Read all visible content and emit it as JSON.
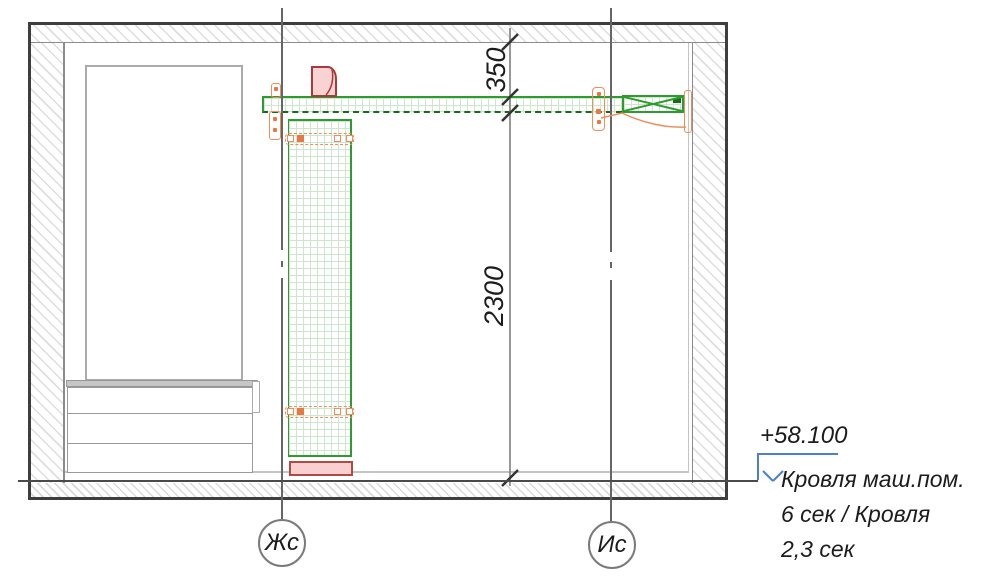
{
  "drawing": {
    "type": "construction-section-detail",
    "dimensions": [
      {
        "label": "350",
        "orientation": "vertical",
        "from": "ceiling-underside",
        "to": "beam-top"
      },
      {
        "label": "2300",
        "orientation": "vertical",
        "from": "beam-bottom",
        "to": "floor-level"
      }
    ],
    "axes": [
      {
        "label": "Жс"
      },
      {
        "label": "Ис"
      }
    ],
    "elevation_mark": {
      "value": "+58.100",
      "lines": [
        "Кровля маш.пом.",
        "6 сек / Кровля",
        "2,3 сек"
      ]
    }
  },
  "colors": {
    "outline": "#3e3e3e",
    "wall_line": "#8c8c8c",
    "light_line": "#c4c4c4",
    "hatch": "#dedede",
    "frame_gray": "#ababab",
    "green": "#2e9b2e",
    "green_dark": "#156e15",
    "green_grid": "#cde6cd",
    "orange": "#ef8d5c",
    "orange_fill": "#e87840",
    "red": "#b04a46",
    "red_dark": "#a83a3a",
    "pink": "#f9cfcf",
    "blue": "#4a7fd4",
    "text": "#1c1c1c",
    "axis_line": "#666666"
  }
}
